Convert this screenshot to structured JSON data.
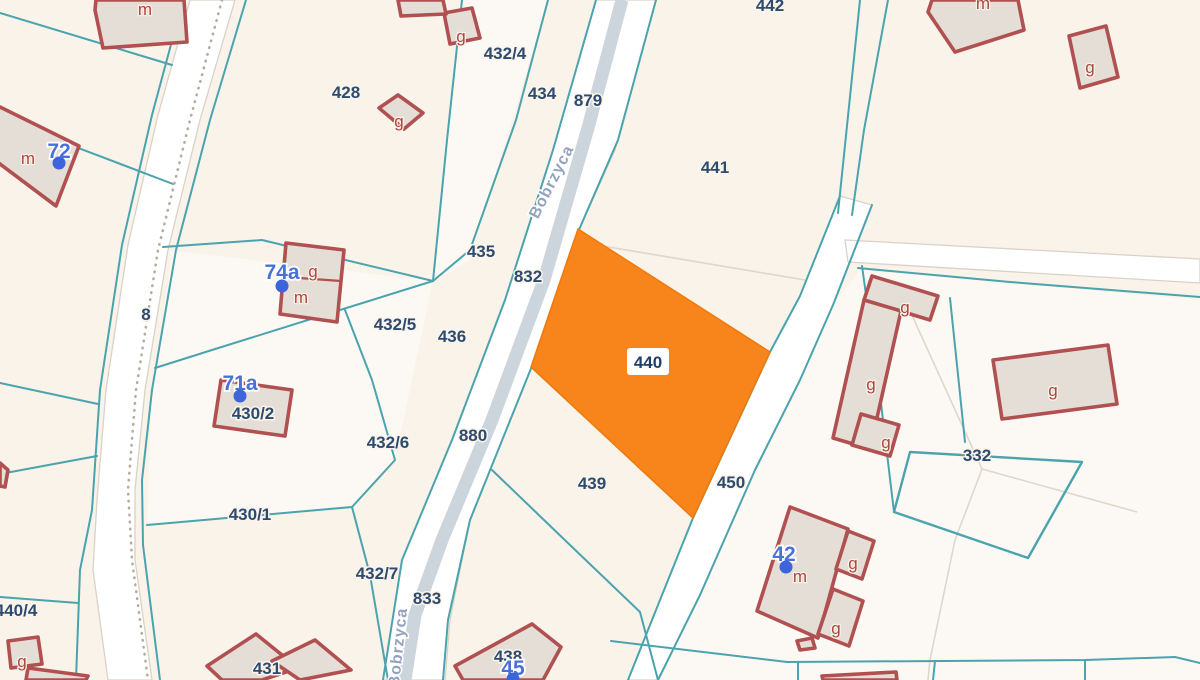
{
  "map": {
    "title": "cadastral-parcel-map",
    "colors": {
      "background": "#f9f3e9",
      "light_parcel": "rgba(255,255,255,0.5)",
      "boundary_teal": "#4aa3ad",
      "road_fill": "#ffffff",
      "road_casing": "#d9d2c7",
      "pavement": "#cdd5dc",
      "dotted_line": "#b5ac9e",
      "faint_line": "#ded7cb",
      "building_fill": "#e5ded6",
      "building_stroke": "#b15050",
      "highlight_fill": "#f8841c",
      "highlight_stroke": "#ef7a09",
      "parcel_text": "#2d4a70",
      "red_text": "#ad473f",
      "address_text": "#4a71d8",
      "address_dot": "#3d65d9",
      "street_text": "#93a3bd"
    },
    "highlight_parcel": {
      "id": "440",
      "points": "578,229 770,352 693,518 531,367",
      "label": {
        "text": "440",
        "x": 648,
        "y": 362,
        "box": {
          "x": 627,
          "y": 348,
          "w": 42,
          "h": 27
        }
      }
    },
    "parcel_labels": [
      {
        "text": "428",
        "x": 346,
        "y": 92
      },
      {
        "text": "432/4",
        "x": 505,
        "y": 53
      },
      {
        "text": "434",
        "x": 542,
        "y": 93
      },
      {
        "text": "879",
        "x": 588,
        "y": 100
      },
      {
        "text": "441",
        "x": 715,
        "y": 167
      },
      {
        "text": "435",
        "x": 481,
        "y": 251
      },
      {
        "text": "832",
        "x": 528,
        "y": 276
      },
      {
        "text": "432/5",
        "x": 395,
        "y": 324
      },
      {
        "text": "436",
        "x": 452,
        "y": 336
      },
      {
        "text": "8",
        "x": 146,
        "y": 314
      },
      {
        "text": "430/2",
        "x": 253,
        "y": 413
      },
      {
        "text": "432/6",
        "x": 388,
        "y": 442
      },
      {
        "text": "880",
        "x": 473,
        "y": 435
      },
      {
        "text": "439",
        "x": 592,
        "y": 483
      },
      {
        "text": "450",
        "x": 731,
        "y": 482
      },
      {
        "text": "430/1",
        "x": 250,
        "y": 514
      },
      {
        "text": "432/7",
        "x": 377,
        "y": 573
      },
      {
        "text": "833",
        "x": 427,
        "y": 598
      },
      {
        "text": "440/4",
        "x": 16,
        "y": 610
      },
      {
        "text": "431",
        "x": 267,
        "y": 668
      },
      {
        "text": "438",
        "x": 508,
        "y": 656
      },
      {
        "text": "332",
        "x": 977,
        "y": 455
      },
      {
        "text": "442",
        "x": 770,
        "y": 5
      },
      {
        "text": "455/2",
        "x": 735,
        "y": 692
      }
    ],
    "building_letter_labels": [
      {
        "text": "m",
        "x": 145,
        "y": 9
      },
      {
        "text": "m",
        "x": 28,
        "y": 158
      },
      {
        "text": "g",
        "x": 399,
        "y": 121
      },
      {
        "text": "g",
        "x": 461,
        "y": 36
      },
      {
        "text": "g",
        "x": 313,
        "y": 271
      },
      {
        "text": "m",
        "x": 301,
        "y": 297
      },
      {
        "text": "g",
        "x": 22,
        "y": 661
      },
      {
        "text": "m",
        "x": 983,
        "y": 3
      },
      {
        "text": "g",
        "x": 1090,
        "y": 67
      },
      {
        "text": "g",
        "x": 905,
        "y": 307
      },
      {
        "text": "g",
        "x": 871,
        "y": 384
      },
      {
        "text": "g",
        "x": 886,
        "y": 442
      },
      {
        "text": "g",
        "x": 1053,
        "y": 390
      },
      {
        "text": "g",
        "x": 853,
        "y": 563
      },
      {
        "text": "g",
        "x": 836,
        "y": 628
      },
      {
        "text": "m",
        "x": 800,
        "y": 576
      }
    ],
    "address_points": [
      {
        "text": "72",
        "x": 59,
        "y": 151,
        "dot_x": 59,
        "dot_y": 163
      },
      {
        "text": "74a",
        "x": 282,
        "y": 272,
        "dot_x": 282,
        "dot_y": 286
      },
      {
        "text": "71a",
        "x": 240,
        "y": 383,
        "dot_x": 240,
        "dot_y": 396
      },
      {
        "text": "45",
        "x": 513,
        "y": 668,
        "dot_x": 513,
        "dot_y": 679
      },
      {
        "text": "42",
        "x": 784,
        "y": 554,
        "dot_x": 786,
        "dot_y": 567
      }
    ],
    "street_labels": [
      {
        "text": "Bobrzyca",
        "x": 556,
        "y": 184,
        "angle": -63
      },
      {
        "text": "Bobrzyca",
        "x": 403,
        "y": 648,
        "angle": -84
      }
    ],
    "geometry": {
      "light_parcels": [
        "462,0 548,0 470,260 433,281 447,140",
        "165,250 433,281 395,460 352,507 147,525 152,390 172,255",
        "860,270 1200,300 1200,680 660,680 700,595 755,470 800,380 833,305"
      ],
      "roads": [
        "190,0 158,115 128,245 106,390 97,500 93,570 108,680 152,680 135,560 135,490 145,390 168,250 200,120 235,0",
        "596,0 553,150 505,300 452,440 402,560 383,680 445,680 450,620 470,520 532,366 578,232 615,150 656,0",
        "840,196 800,296 770,352 693,518 660,600 628,680 658,680 700,595 755,470 800,380 833,305 872,205",
        "845,240 1200,259 1200,283 848,262"
      ],
      "pavement_lines": [
        "622,0 588,128 544,280 492,420 442,540 415,615 405,680"
      ],
      "teal_lines": [
        "0,13 172,65",
        "60,141 173,184",
        "183,0 152,115 122,245 100,390 92,510 80,570 76,680",
        "246,0 210,120 176,250 152,390 142,480 143,545 160,680",
        "0,474 97,456",
        "0,597 78,603",
        "0,383 98,404",
        "147,525 352,507 370,575 388,680",
        "163,247 262,240 433,281",
        "433,281 340,310 212,350 155,368",
        "345,310 372,380 395,460 352,507",
        "462,0 447,140 433,281",
        "548,0 516,120 470,250 433,281",
        "596,0 553,150 505,300 452,440 402,560 383,680",
        "656,0 618,140 578,232 532,366 470,520 448,620 443,680",
        "492,470 570,545 640,612 658,680",
        "840,196 800,296 770,352 693,518 660,600 628,680",
        "872,205 833,305 800,380 755,470 700,595 658,680",
        "860,0 838,213",
        "888,0 864,130 852,215",
        "858,268 1010,282 1200,297",
        "950,298 965,442",
        "862,266 880,395 894,512",
        "611,641 787,662 1085,660 1175,657 1200,663",
        "798,662 798,680",
        "935,661 933,680",
        "1085,660 1085,680"
      ],
      "teal_quad": "910,452 1082,462 1028,558 894,512",
      "faint_lines": [
        "585,243 805,280",
        "900,289 982,469",
        "982,469 1137,512",
        "982,469 955,540 930,660 928,680"
      ],
      "dotted_lines": [
        "222,0 190,120 158,250 136,390 128,490 132,560 148,680"
      ],
      "buildings": [
        "96,0 184,0 187,42 103,48 95,10",
        "-8,103 79,146 56,206 -8,158",
        "379,108 398,95 423,113 404,129",
        "444,13 472,8 480,38 450,44",
        "398,0 443,0 446,14 401,16",
        "286,243 344,250 337,322 280,314",
        "221,380 292,390 285,436 214,426",
        "8,641 38,637 42,664 11,668",
        "28,668 88,676 86,680 26,680",
        "0,463 8,470 5,487 0,486",
        "207,666 256,634 298,668 262,680 222,680",
        "272,661 315,640 351,670 300,680",
        "455,666 532,624 561,647 543,680 463,680",
        "790,507 848,529 818,638 757,611",
        "848,531 874,541 862,579 836,569",
        "833,589 863,601 849,646 818,634",
        "872,276 938,296 930,320 864,300",
        "864,300 901,311 870,449 833,438",
        "861,414 899,425 890,456 852,445",
        "993,360 1108,345 1117,404 1002,419",
        "932,0 1018,0 1024,30 955,52 928,12",
        "1069,36 1106,26 1118,77 1080,88",
        "797,641 812,638 815,648 800,650",
        "822,676 896,672 897,680 823,680"
      ],
      "building_dividers": [
        "285,277 341,281"
      ]
    }
  }
}
